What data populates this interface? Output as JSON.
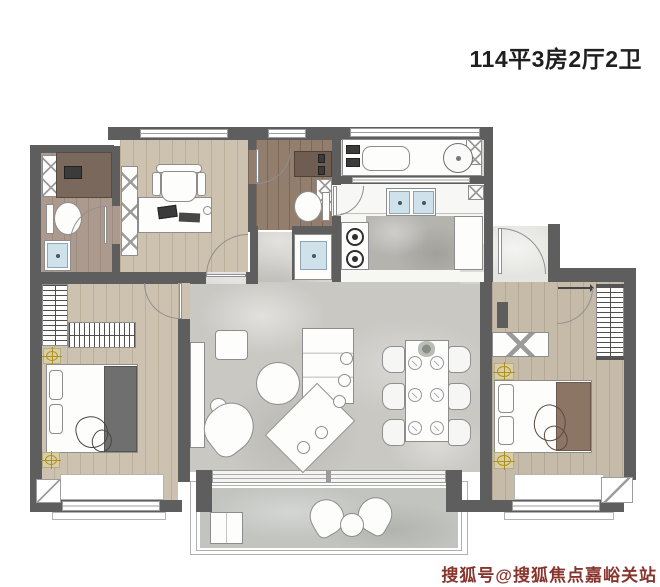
{
  "title": {
    "text": "114平3房2厅2卫"
  },
  "watermark": {
    "text": "搜狐号@搜狐焦点嘉峪关站"
  },
  "colors": {
    "wall": "#5e5e5e",
    "wood": "#cdc2af",
    "wood-gray": "#c6bba9",
    "wood-dark": "#937d6d",
    "wood-bath": "#ab9a8d",
    "marble": "#c9c8c3",
    "marble-dark": "#b5b3ae",
    "balcony": "#c2c4c0",
    "laundry": "#d3d5d1",
    "fixture": "#fdfdfc",
    "line": "#8d8d8d",
    "basin-blue": "#cfe1eb",
    "lamp-gold": "#b08f1e",
    "duvet-charcoal": "#6f6f6f",
    "duvet-taupe": "#8d7566",
    "title-text": "#1f1f1f",
    "watermark-red": "#7d241b"
  },
  "plan": {
    "rooms": [
      "study",
      "bathroom",
      "bathroom-2",
      "laundry-balcony",
      "kitchen",
      "living-dining-room",
      "bedroom",
      "master-bedroom",
      "walk-in-closet",
      "balcony",
      "hallway"
    ],
    "furniture_icons": [
      "desk",
      "office-chair",
      "bookshelf",
      "toilet",
      "washbasin",
      "vanity",
      "bathtub",
      "washing-machine",
      "gas-stove",
      "kitchen-sink",
      "tv-bench",
      "coffee-table",
      "side-table",
      "armchair",
      "corner-sofa",
      "dining-table",
      "dining-chair",
      "plate",
      "bed",
      "pillow",
      "nightstand-lamp",
      "wardrobe-hangers",
      "balcony-chair",
      "balcony-table",
      "sliding-door",
      "door-swing",
      "window"
    ]
  }
}
